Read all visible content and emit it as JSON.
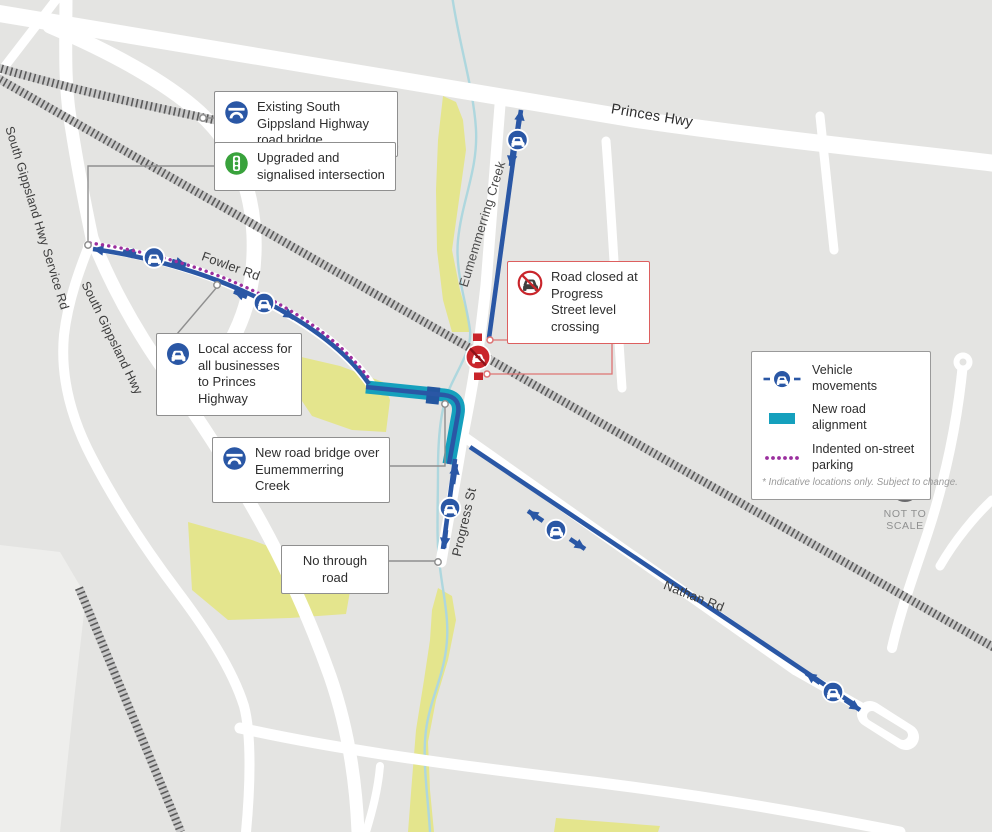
{
  "colors": {
    "background": "#e4e4e2",
    "road": "#ffffff",
    "accent_blue": "#2a57a5",
    "teal_new_road": "#15a0bd",
    "purple_parking": "#9b2f9e",
    "green_area": "#e4e58d",
    "creek_blue": "#aed7de",
    "rail_grey": "#5a5a5a",
    "alert_red": "#c9252b"
  },
  "road_labels": {
    "princes": "Princes Hwy",
    "sg_service": "South Gippsland Hwy Service Rd",
    "sg_hwy": "South Gippsland Hwy",
    "fowler": "Fowler Rd",
    "creek": "Eumemmerring Creek",
    "progress": "Progress St",
    "nathan": "Nathan Rd"
  },
  "callouts": {
    "existing_bridge": "Existing South Gippsland Highway road bridge",
    "upgraded_intersection": "Upgraded and signalised intersection",
    "local_access": "Local access for all businesses to Princes Highway",
    "new_bridge": "New road bridge over Eumemmerring Creek",
    "no_through": "No through road",
    "road_closed": "Road closed at Progress Street level crossing"
  },
  "legend": {
    "items": [
      {
        "label": "Vehicle movements"
      },
      {
        "label": "New road alignment"
      },
      {
        "label": "Indented on-street parking"
      }
    ],
    "footnote": "* Indicative locations only. Subject to change."
  },
  "compass": {
    "line1": "NOT TO",
    "line2": "SCALE"
  }
}
